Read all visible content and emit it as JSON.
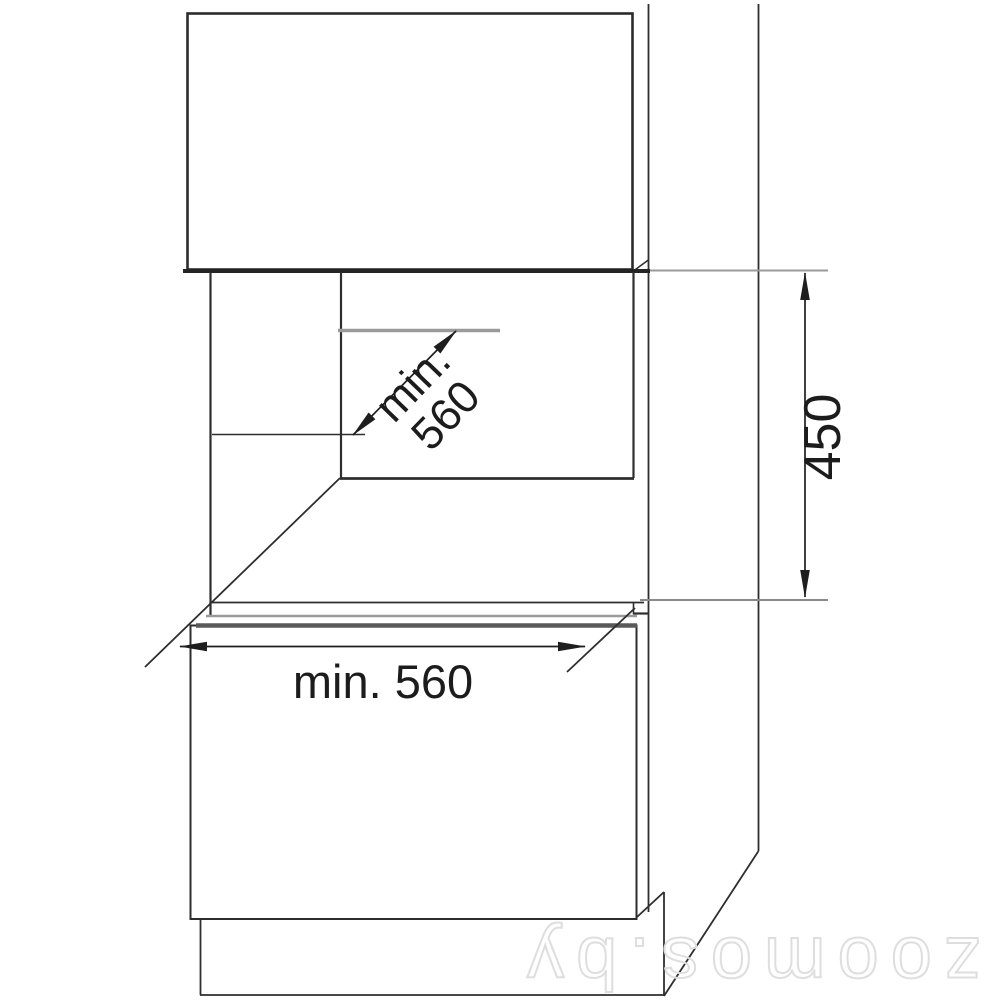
{
  "meta": {
    "background_color": "#ffffff",
    "line_color": "#2e2e2e",
    "gray_line_color": "#9a9a9a",
    "dimension_color": "#1e1e1e",
    "watermark_color": "#dedede"
  },
  "diagram": {
    "type": "installation-drawing",
    "subject": "built-in appliance cabinet niche with minimum installation dimensions",
    "dimensions": [
      {
        "id": "niche-depth",
        "label_line1": "min.",
        "label_line2": "560",
        "value": 560,
        "unit": "mm",
        "orientation": "diagonal"
      },
      {
        "id": "niche-height",
        "label": "450",
        "value": 450,
        "unit": "mm",
        "orientation": "vertical"
      },
      {
        "id": "niche-width",
        "label": "min. 560",
        "value": 560,
        "unit": "mm",
        "orientation": "horizontal"
      }
    ]
  },
  "watermark": {
    "text": "zoomos.by",
    "rotated_180": true
  }
}
